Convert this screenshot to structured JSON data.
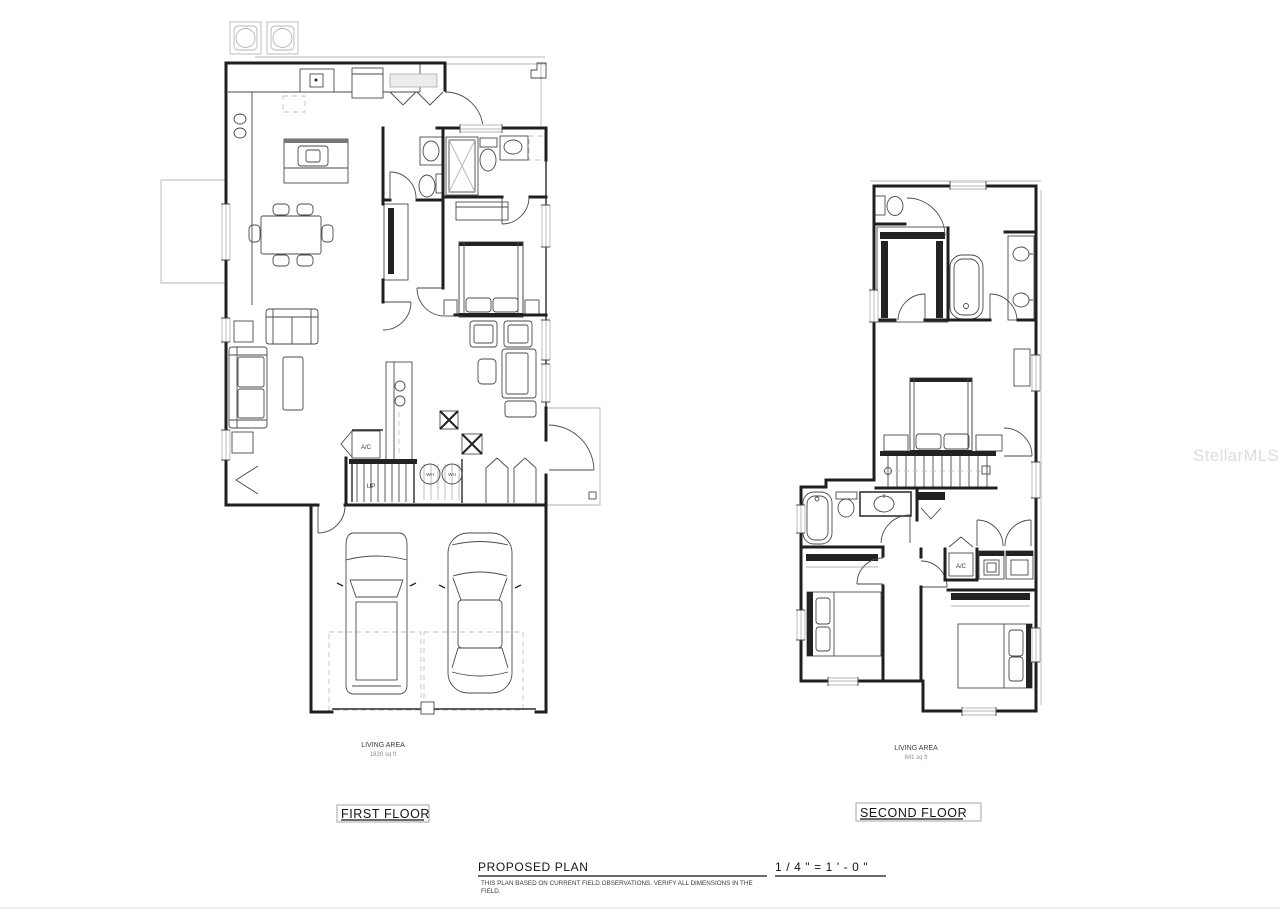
{
  "watermark": "StellarMLS",
  "first_floor": {
    "floor_label": "FIRST FLOOR",
    "living_area_label": "LIVING AREA",
    "living_area_value": "1839 sq ft",
    "ac_label": "A/C",
    "up_label": "UP",
    "wh_label_1": "WH",
    "wh_label_2": "WH"
  },
  "second_floor": {
    "floor_label": "SECOND FLOOR",
    "living_area_label": "LIVING AREA",
    "living_area_value": "841 sq ft",
    "ac_label": "A/C"
  },
  "title_block": {
    "title": "PROPOSED PLAN",
    "scale": "1 / 4 \"  =  1 ' - 0 \"",
    "note_line1": "THIS PLAN BASED ON CURRENT FIELD OBSERVATIONS. VERIFY ALL DIMENSIONS IN THE",
    "note_line2": "FIELD."
  }
}
